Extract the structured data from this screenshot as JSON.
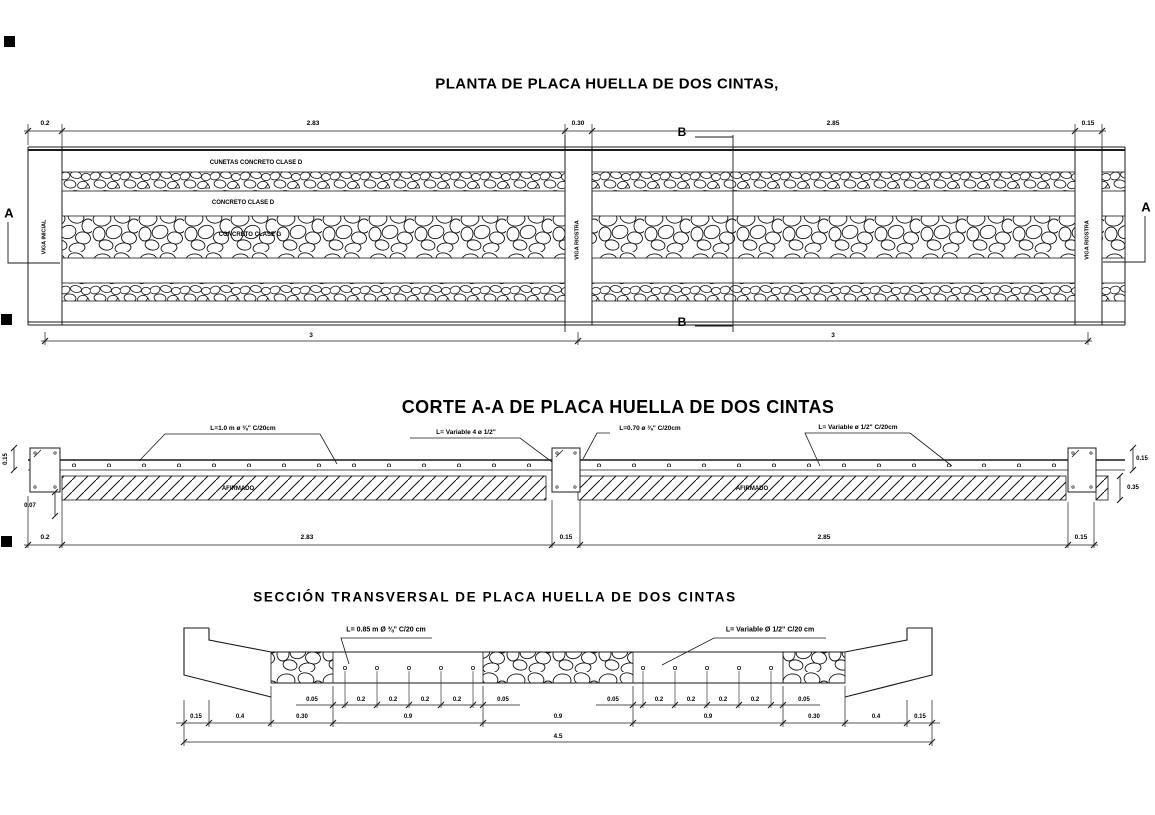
{
  "plan": {
    "title": "PLANTA DE PLACA HUELLA DE DOS CINTAS,",
    "band_labels": {
      "cunetas": "CUNETAS CONCRETO CLASE D",
      "concreto_d": "CONCRETO CLASE D",
      "concreto_g": "CONCRETO CLASE G"
    },
    "beam_labels": {
      "left": "VIGA INICIAL",
      "middle": "VIGA RIOSTRA",
      "right": "VIGA RIOSTRA"
    },
    "markers": {
      "a": "A",
      "b": "B"
    },
    "dims_top": [
      "0.2",
      "2.83",
      "0.30",
      "2.85",
      "0.15"
    ],
    "dims_bottom": [
      "3",
      "3"
    ]
  },
  "corte": {
    "title": "CORTE A-A DE PLACA HUELLA DE DOS CINTAS",
    "annotations": [
      "L=1.0 m ø ⅜\" C/20cm",
      "L= Variable 4 ø 1/2\"",
      "L=0.70 ø ⅜\" C/20cm",
      "L= Variable ø 1/2\" C/20cm"
    ],
    "afirmado": [
      "AFIRMADO",
      "AFIRMADO"
    ],
    "dims_left": [
      "0.15",
      "0.07"
    ],
    "dims_right": [
      "0.15",
      "0.35"
    ],
    "dims_bottom": [
      "0.2",
      "2.83",
      "0.15",
      "2.85",
      "0.15"
    ]
  },
  "seccion": {
    "title": "SECCIÓN TRANSVERSAL DE PLACA HUELLA DE DOS CINTAS",
    "annotations": [
      "L= 0.85 m Ø ⅜\" C/20 cm",
      "L= Variable Ø 1/2\" C/20 cm"
    ],
    "dims_row1_left": [
      "0.05",
      "0.2",
      "0.2",
      "0.2",
      "0.2",
      "0.05"
    ],
    "dims_row1_right": [
      "0.05",
      "0.2",
      "0.2",
      "0.2",
      "0.2",
      "0.05"
    ],
    "dims_row2": [
      "0.15",
      "0.4",
      "0.30",
      "0.9",
      "0.9",
      "0.9",
      "0.30",
      "0.4",
      "0.15"
    ],
    "dim_total": "4.5"
  }
}
